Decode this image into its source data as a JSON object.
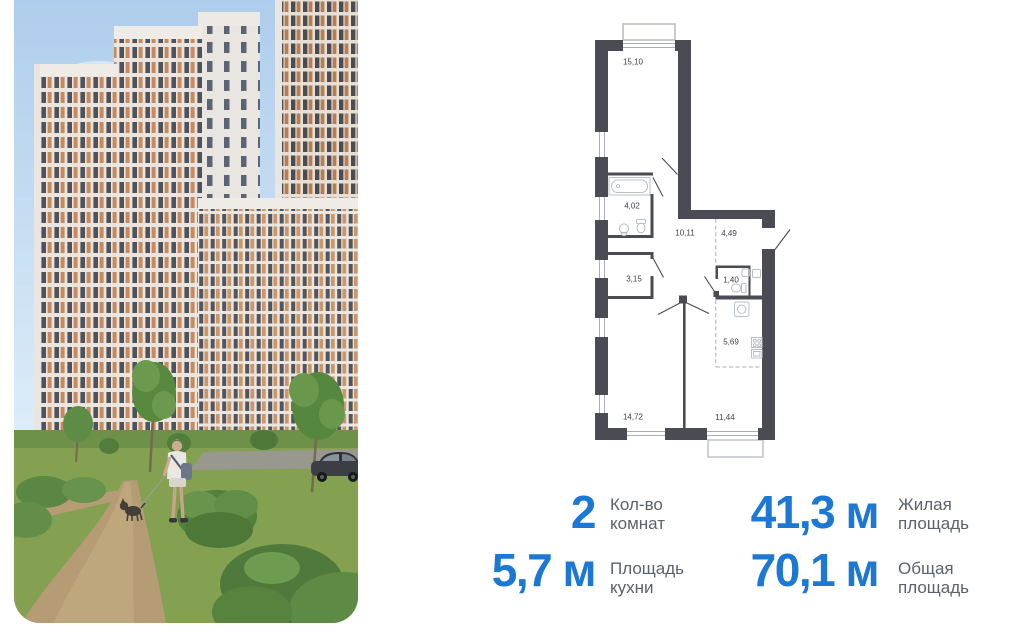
{
  "photo": {
    "alt": "residential-complex-exterior-with-park"
  },
  "floor_plan": {
    "rooms": [
      {
        "id": "living-room",
        "area": "15,10"
      },
      {
        "id": "bathroom",
        "area": "4,02"
      },
      {
        "id": "hallway",
        "area": "10,11"
      },
      {
        "id": "entry",
        "area": "4,49"
      },
      {
        "id": "storage",
        "area": "3,15"
      },
      {
        "id": "wc",
        "area": "1,40"
      },
      {
        "id": "kitchen-zone",
        "area": "5,69"
      },
      {
        "id": "bedroom-1",
        "area": "14,72"
      },
      {
        "id": "bedroom-2",
        "area": "11,44"
      }
    ]
  },
  "stats": {
    "rooms_count": {
      "value": "2",
      "line1": "Кол-во",
      "line2": "комнат"
    },
    "living_area": {
      "value": "41,3 м",
      "line1": "Жилая",
      "line2": "площадь"
    },
    "kitchen_area": {
      "value": "5,7 м",
      "line1": "Площадь",
      "line2": "кухни"
    },
    "total_area": {
      "value": "70,1 м",
      "line1": "Общая",
      "line2": "площадь"
    }
  },
  "colors": {
    "accent_blue": "#1d78d3",
    "label_gray": "#5b626b",
    "plan_wall": "#4b4b53"
  }
}
